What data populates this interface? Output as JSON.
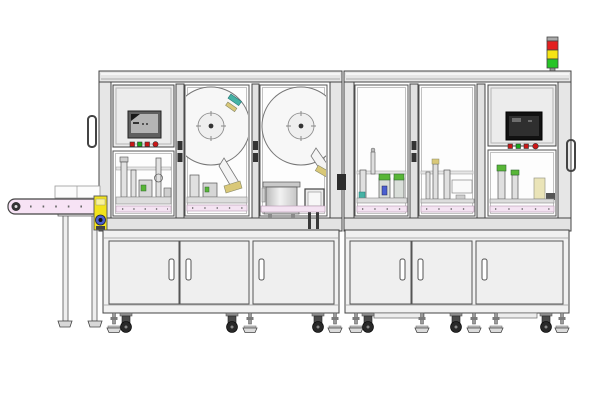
{
  "illustration": {
    "description": "Side elevation technical drawing of a two-bay automated assembly and labeling machine with an outfeed belt conveyor on the left",
    "background": "#ffffff"
  },
  "colors": {
    "outline": "#444444",
    "frame_fill": "#e6e6e6",
    "glass": "#fdfdfd",
    "panel": "#ececec",
    "door": "#efefef",
    "belt_pink": "#f7e3f5",
    "work_strip_pink": "#f4e3f2",
    "accent_yellow": "#f2e31c",
    "tower_red": "#e32020",
    "tower_yellow": "#f6e414",
    "tower_green": "#27c427",
    "button_red": "#cc1616",
    "button_green": "#18a818",
    "screen_left_frame": "#5f5f5f",
    "screen_left_fill": "#b4b4b4",
    "screen_right_fill": "#121212",
    "screen_right_inner": "#2f2f2f",
    "gripper_green": "#58b637",
    "part_blue": "#4a5fd0",
    "part_teal": "#45b2a4",
    "part_khaki": "#d9c878",
    "wheel_dark": "#282828"
  },
  "components": {
    "signal_tower": {
      "lights": [
        "red",
        "yellow",
        "green"
      ]
    },
    "hmi_left": {
      "screen": "gray-lcd",
      "buttons": [
        "red",
        "green",
        "red",
        "red"
      ]
    },
    "hmi_right": {
      "screen": "black-lcd",
      "buttons": [
        "red",
        "green",
        "red",
        "red"
      ]
    },
    "label_reels": 2,
    "bowl_feeder": 1,
    "cabinet_doors_left": 3,
    "cabinet_doors_right": 3,
    "outfeed_conveyor": 1,
    "door_handles_side": 2
  }
}
